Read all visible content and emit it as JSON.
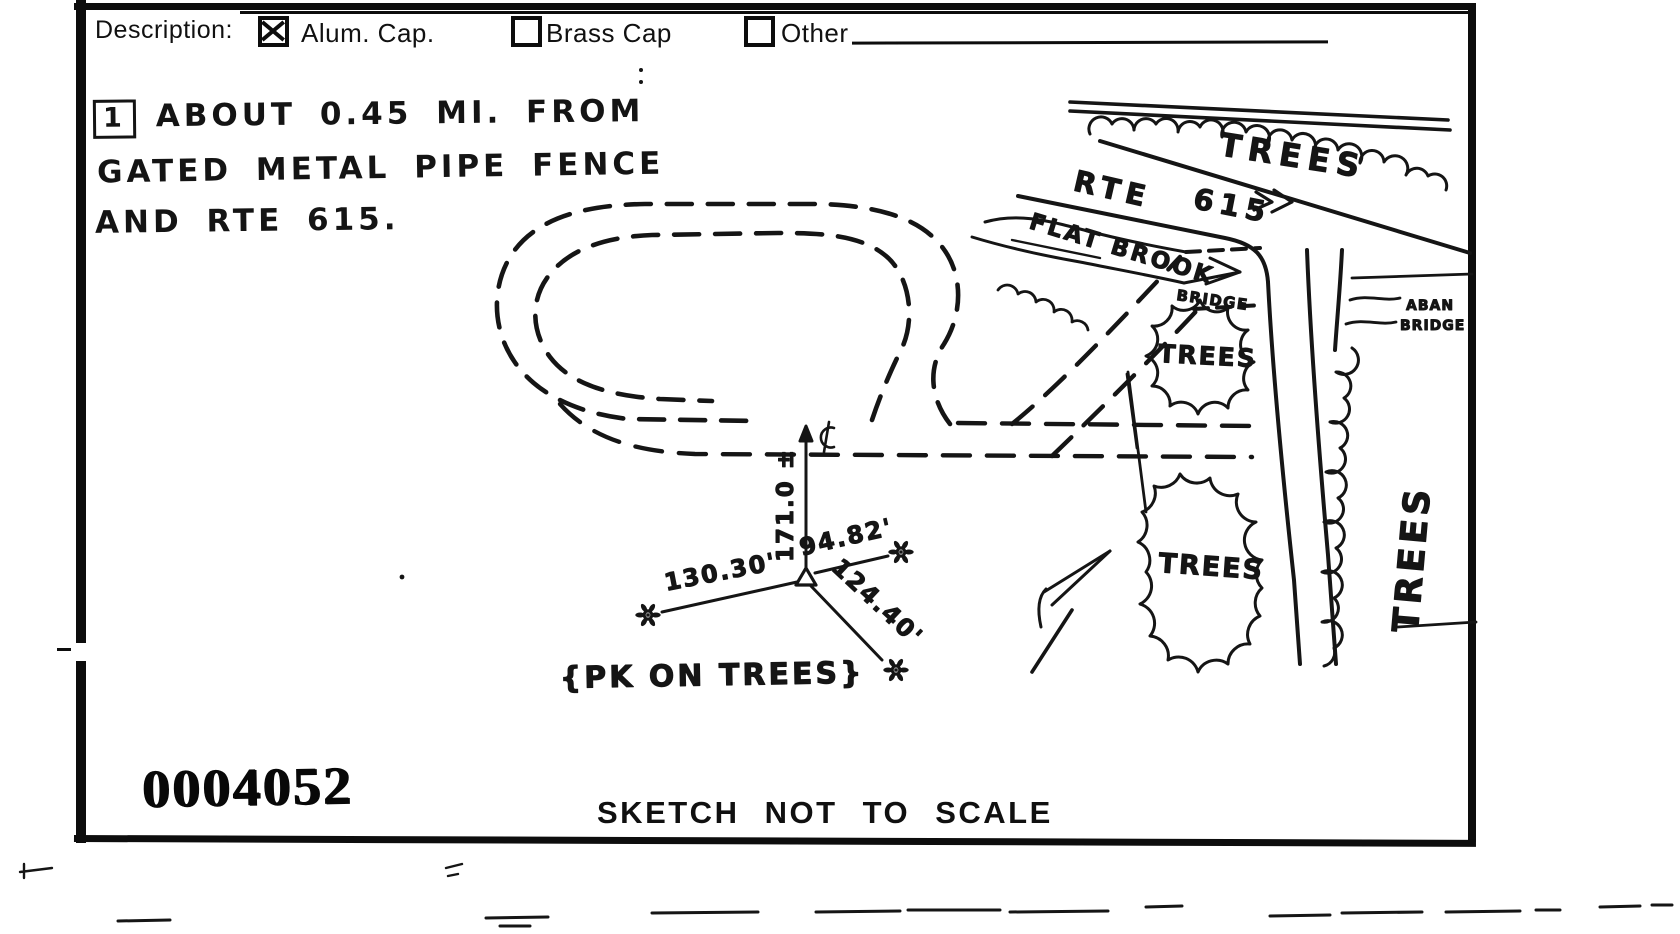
{
  "form": {
    "description_label": "Description:",
    "checkboxes": [
      {
        "label": "Alum. Cap.",
        "checked": true
      },
      {
        "label": "Brass Cap",
        "checked": false
      },
      {
        "label": "Other",
        "checked": false
      }
    ]
  },
  "note": {
    "marker": "1",
    "line1": "ABOUT 0.45 MI. FROM",
    "line2": "GATED METAL PIPE FENCE",
    "line3": "AND RTE 615."
  },
  "sketch": {
    "labels": {
      "trees_top": "TREES",
      "rte": "RTE",
      "route_number": "615",
      "flat_brook": "FLAT BROOK",
      "bridge": "BRIDGE",
      "aban_line1": "ABAN",
      "aban_line2": "BRIDGE",
      "trees_mid": "TREES",
      "trees_lower": "TREES",
      "trees_right_vertical": "TREES",
      "tie_north": "171.0 ±",
      "tie_west": "130.30'",
      "tie_northeast": "94.82'",
      "tie_southeast": "124.40'",
      "pk_note": "{PK ON TREES}"
    }
  },
  "footer": {
    "stamp": "0004052",
    "caption": "SKETCH NOT TO SCALE"
  },
  "colors": {
    "ink": "#141414",
    "paper": "#ffffff"
  },
  "icons": {
    "checkbox-checked-icon": "☒",
    "checkbox-icon": "☐",
    "centerline-icon": "℄",
    "monument-triangle-icon": "△",
    "tree-icon": "❀",
    "north-arrow-icon": "➚",
    "flow-arrow-icon": "→",
    "route-direction-arrow-icon": "»"
  }
}
